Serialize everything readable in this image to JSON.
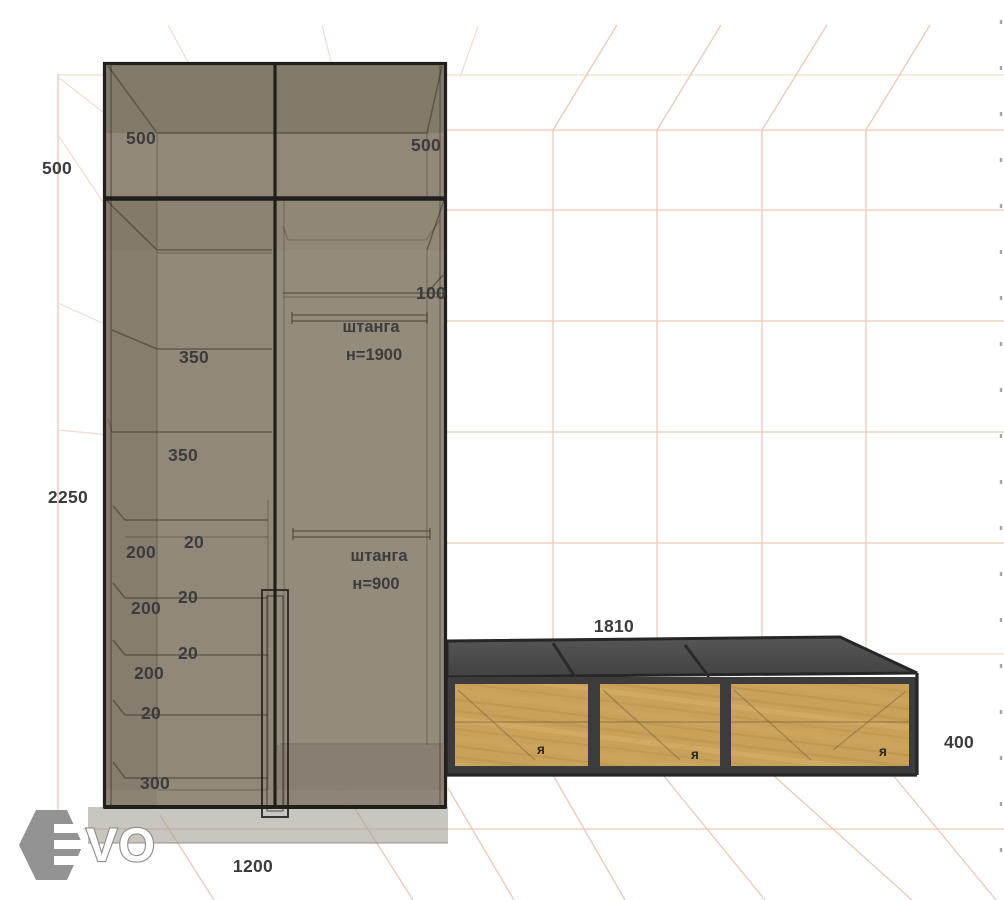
{
  "scene": {
    "title": "wardrobe-3d-dimension-preview"
  },
  "dimensions": {
    "cabinet_depth_top": "500",
    "cabinet_top_left_section": "500",
    "cabinet_top_right_section": "500",
    "cabinet_height": "2250",
    "top_shelf_gap": "100",
    "shelf_gap_upper": "350",
    "shelf_gap_lower": "350",
    "drawer_heights": [
      "200",
      "200",
      "200"
    ],
    "drawer_gaps": [
      "20",
      "20",
      "20",
      "20"
    ],
    "bottom_section": "300",
    "cabinet_width": "1200",
    "bench_length": "1810",
    "bench_height": "400"
  },
  "rods": {
    "upper_label": "штанга",
    "upper_height": "н=1900",
    "lower_label": "штанга",
    "lower_height": "н=900"
  },
  "bench": {
    "compartment_marks": [
      "я",
      "я",
      "я"
    ]
  },
  "logo": {
    "text": "VO"
  },
  "colors": {
    "cabinet_body": "#8d8375",
    "cabinet_frame": "#211f1b",
    "bench_top": "#4d4d4d",
    "bench_frame": "#3c3c3c",
    "bench_wood": "#c9a15b",
    "grid_line": "#eccab4",
    "label_text": "#3c3c3c",
    "logo_gray": "#8d8d8d"
  }
}
